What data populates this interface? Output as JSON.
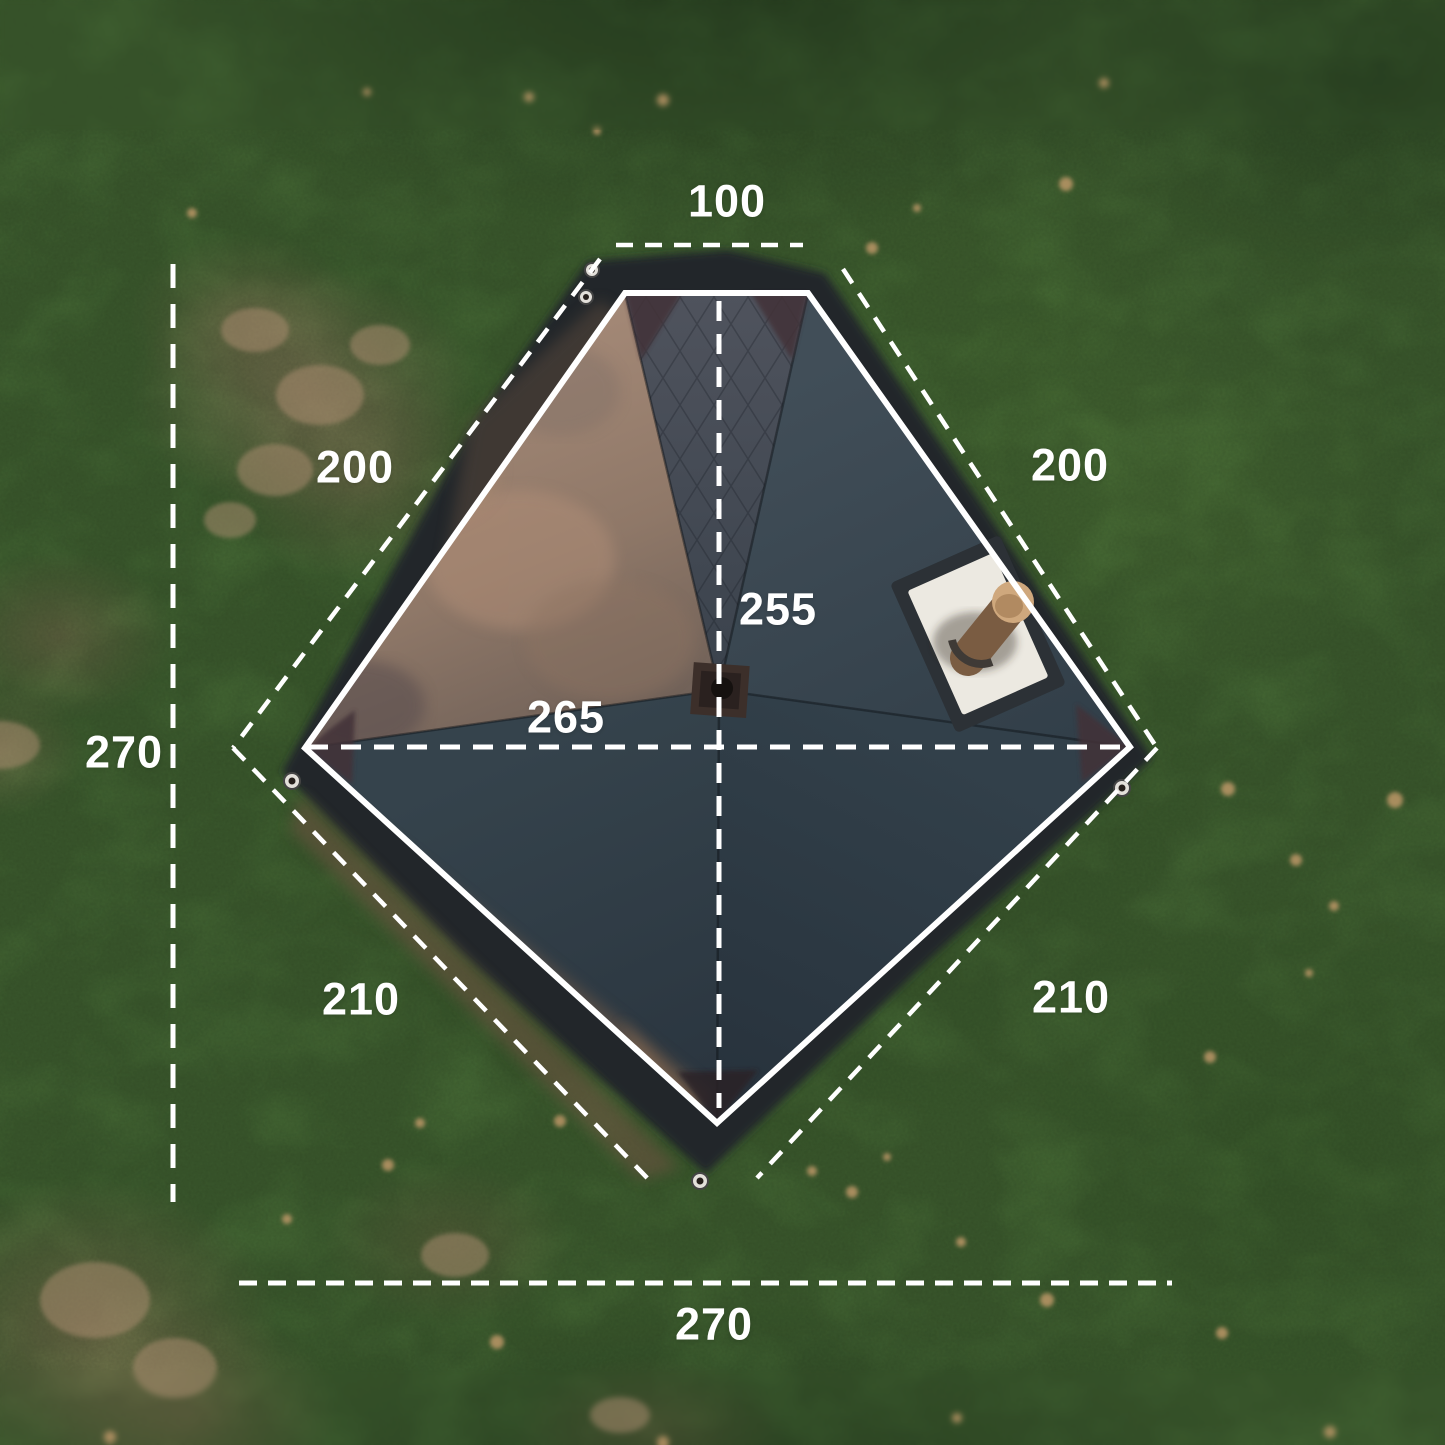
{
  "page": {
    "title": "Tent top view with dimensions"
  },
  "measurements": {
    "top_width": "100",
    "upper_left_edge": "200",
    "upper_right_edge": "200",
    "inner_vertical": "255",
    "inner_horizontal": "265",
    "left_height": "270",
    "lower_left_edge": "210",
    "lower_right_edge": "210",
    "bottom_width": "270"
  },
  "scene": {
    "subject": "hot tent seen from above on grass",
    "features": [
      "stove-jack-pad",
      "chimney-pipe",
      "peak-hub",
      "stake-grommets"
    ]
  },
  "colors": {
    "annotation_white": "#ffffff",
    "grass_green": "#4a7138",
    "dirt_tan": "#a58c6c",
    "tent_slate": "#39454f",
    "tent_bronze": "#9b8070",
    "skirt_dark": "#20282c",
    "stove_pad_white": "#ece9e1",
    "chimney_tan": "#cfa87d"
  }
}
